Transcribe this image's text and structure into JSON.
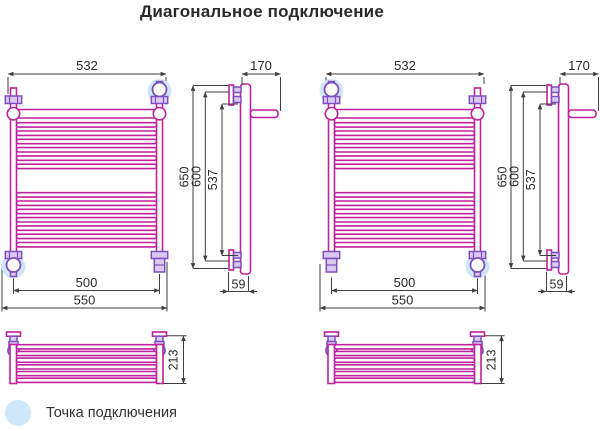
{
  "title": "Диагональное подключение",
  "legend": {
    "label": "Точка подключения",
    "marker": "connection-point-highlight"
  },
  "dimensions": {
    "rail_width": "532",
    "bracket_depth": "170",
    "overall_height": "650",
    "axes_height": "600",
    "bracket_height": "537",
    "axes_width": "500",
    "overall_width": "550",
    "wall_clearance": "59",
    "shelf_depth": "213"
  },
  "colors": {
    "rail": "#c0219c",
    "fitting": "#7d4fc0",
    "fitting_fill": "#dcc9ef",
    "highlight": "#cfe7f8",
    "dimension": "#3f3f3f",
    "text": "#2a2a2a",
    "background": "#ffffff"
  }
}
